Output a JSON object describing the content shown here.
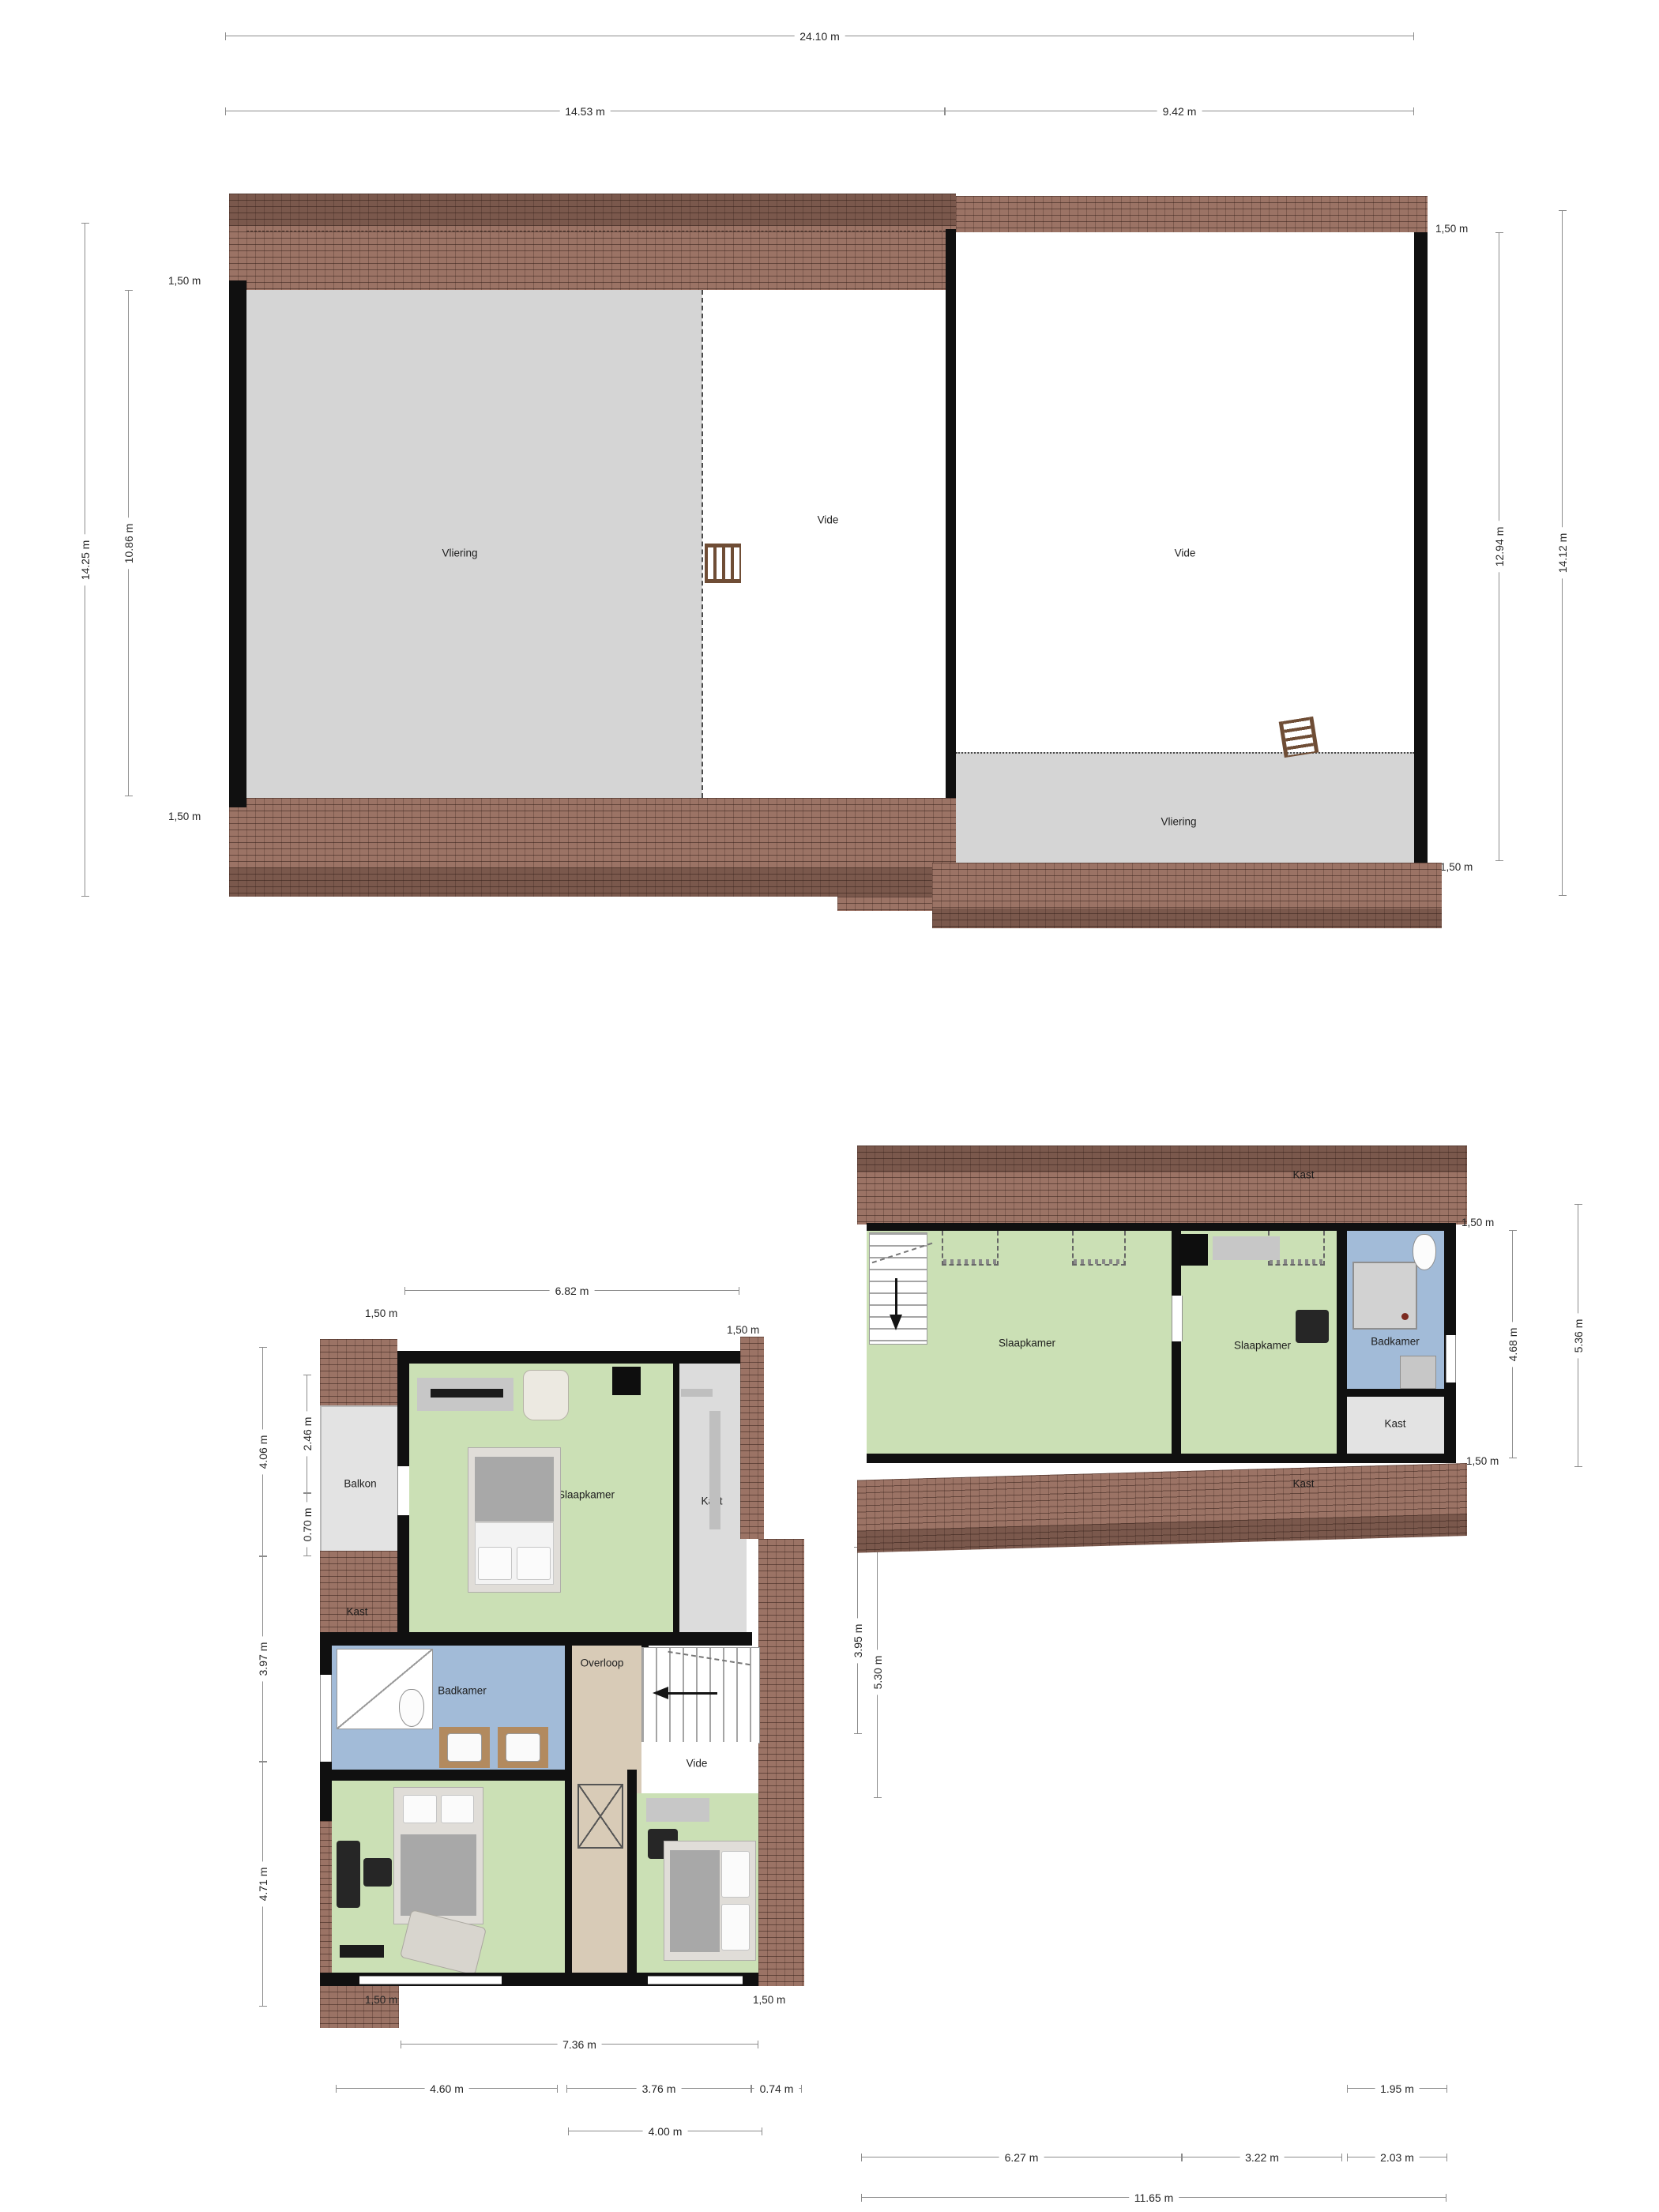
{
  "document": {
    "type": "floor-plan-sheet",
    "language": "nl"
  },
  "colors": {
    "roof": "#9b7365",
    "room_green": "#cbe0b5",
    "room_blue": "#a2bbd8",
    "room_gray": "#d5d5d5",
    "balkon_gray": "#e3e3e3",
    "overloop_tan": "#d8cbb7",
    "wall": "#101010",
    "dim_line": "#8c8c8c",
    "background": "#ffffff"
  },
  "attic": {
    "dims": {
      "total_width": "24.10 m",
      "left_width": "14.53 m",
      "right_width": "9.42 m",
      "left_outer_height": "14.25 m",
      "left_inner_height": "10.86 m",
      "right_inner_height": "12.94 m",
      "right_outer_height": "14.12 m",
      "knee_top_left": "1,50 m",
      "knee_bottom_left": "1,50 m",
      "knee_top_right": "1,50 m",
      "knee_bottom_right": "1,50 m"
    },
    "rooms": {
      "vliering_left": "Vliering",
      "vide_left": "Vide",
      "vide_right": "Vide",
      "vliering_right": "Vliering"
    }
  },
  "floor1": {
    "dims": {
      "top_width": "6.82 m",
      "knee_top_left": "1,50 m",
      "knee_top_right": "1,50 m",
      "knee_bottom_left": "1,50 m",
      "knee_bottom_right": "1,50 m",
      "left_outer_top": "4.06 m",
      "left_inner_top": "2.46 m",
      "left_small": "0.70 m",
      "left_mid": "3.97 m",
      "left_bottom": "4.71 m",
      "right_upper": "3.95 m",
      "right_lower": "5.30 m",
      "bottom_total": "7.36 m",
      "bottom_1": "4.60 m",
      "bottom_2": "3.76 m",
      "bottom_3": "0.74 m",
      "bottom_4": "4.00 m"
    },
    "rooms": {
      "balkon": "Balkon",
      "kast_left": "Kast",
      "slaapkamer_top": "Slaapkamer",
      "kast_right": "Kast",
      "badkamer": "Badkamer",
      "overloop": "Overloop",
      "vide": "Vide",
      "slaapkamer_left": "Slaapkamer",
      "slaapkamer_right": "Slaapkamer"
    }
  },
  "floor2": {
    "dims": {
      "knee_top": "1,50 m",
      "knee_bottom": "1,50 m",
      "right_inner": "4.68 m",
      "right_outer": "5.36 m",
      "bottom_kast": "1.95 m",
      "bottom_1": "6.27 m",
      "bottom_2": "3.22 m",
      "bottom_3": "2.03 m",
      "bottom_total": "11.65 m"
    },
    "rooms": {
      "kast_top": "Kast",
      "slaapkamer_left": "Slaapkamer",
      "slaapkamer_right": "Slaapkamer",
      "badkamer": "Badkamer",
      "kast_right": "Kast",
      "kast_bottom": "Kast"
    }
  }
}
